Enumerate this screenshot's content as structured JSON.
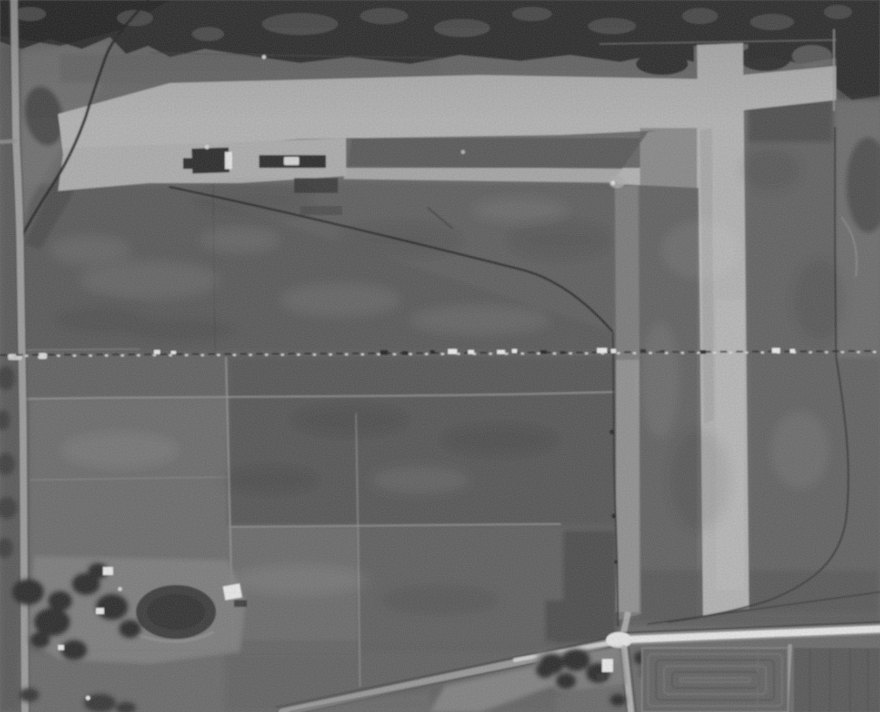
{
  "image": {
    "kind": "black-and-white aerial photograph",
    "subject": "Grayscale aerial photo of a rural airfield: bright L-shaped turf runways (east-west strip across the top, north-south strip on the right), hangar buildings on the apron, dark cultivated fields, a dashed survey section line across the middle, boundary fences, country roads and two farmsteads with trees and a pond",
    "overlay_text": ""
  },
  "palette": {
    "base": "#676767",
    "fieldDark": "#545454",
    "fieldDarker": "#484848",
    "fieldMid": "#5d5d5d",
    "fieldLight": "#6d6d6d",
    "fieldLighter": "#7a7a7a",
    "scrubDark": "#2a2a2a",
    "scrubCore": "#1f1f1f",
    "scrubMottle": "#565656",
    "runway": "#b4b4b4",
    "runwayDim": "#a2a2a2",
    "runwayBright": "#bdbdbd",
    "apron": "#aeaeae",
    "taxiway": "#939393",
    "taxiwayFaint": "#7e7e7e",
    "roadLight": "#a0a0a0",
    "roadWhite": "#ebebeb",
    "roadPale": "#b6b6b6",
    "shoulder": "#878787",
    "fence": "#222222",
    "fenceSoft": "#303030",
    "trees": "#262626",
    "treesSoft": "#383838",
    "pond": "#373737",
    "pondCore": "#2d2d2d",
    "yard": "#7e7e7e",
    "building": "#eeeeee",
    "buildingDim": "#d9d9d9",
    "hangar": "#272727",
    "shadow": "#333333",
    "lineLight": "#8f8f8f",
    "lineDark": "#494949",
    "speckWhite": "#f2f2f2",
    "dashDark": "#1e1e1e",
    "dashWhite": "#e6e6e6",
    "cornerDark": "#454545",
    "blobDark": "#414141",
    "kidneyDark": "#3e3e3e",
    "triangleDark": "#484848",
    "medianDark": "#555555",
    "furrowBase": "#606060",
    "furrowDark": "#505050",
    "furrowLight": "#707070",
    "rightField": "#555555",
    "transition": "#606060",
    "upperLeftLight": "#717171"
  },
  "features": {
    "photo": {
      "label": "Black-and-white aerial photograph of a rural airfield"
    },
    "runway_ew": {
      "label": "East-west runway"
    },
    "runway_ns": {
      "label": "North-south runway"
    },
    "apron": {
      "label": "Apron and hangar area"
    },
    "taxiway": {
      "label": "Taxiway strip along airfield east side"
    },
    "hangars": {
      "label": "Hangar buildings"
    },
    "boundary_fence": {
      "label": "Airfield boundary fence"
    },
    "section_line": {
      "label": "Dashed section line across photo"
    },
    "farmstead_west": {
      "label": "Farmstead with trees and pond"
    },
    "farmstead_south": {
      "label": "Farmstead at road intersection"
    },
    "road_west": {
      "label": "North-south road at west edge"
    },
    "road_south": {
      "label": "East-west white road at south"
    },
    "road_diagonal": {
      "label": "Diagonal road from southwest"
    },
    "furrow_field": {
      "label": "Plowed field with concentric furrows"
    },
    "scrub_north": {
      "label": "Dark brush terrain along north edge"
    },
    "fields": {
      "label": "Cultivated farm fields"
    }
  }
}
